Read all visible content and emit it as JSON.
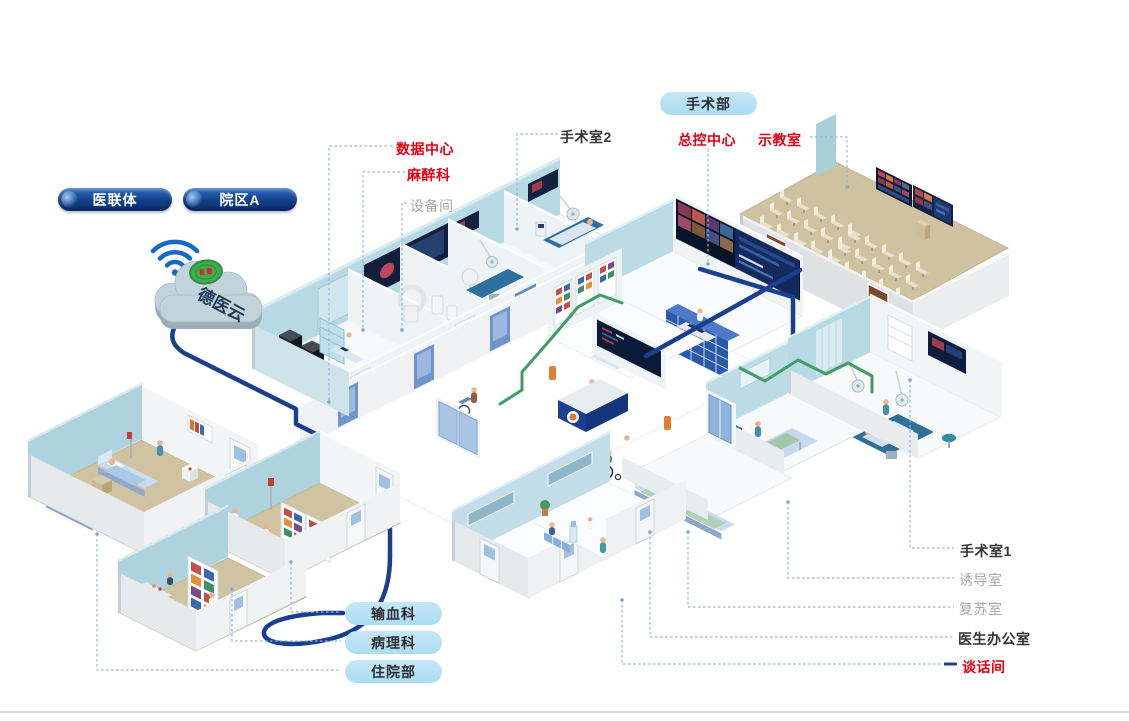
{
  "canvas": {
    "width": 1129,
    "height": 721
  },
  "palette": {
    "label_red": "#e60012",
    "label_dark": "#333333",
    "label_gray": "#a8a8a8",
    "leader_blue": "#8fb7dd",
    "cable_blue": "#1b3f8f",
    "cable_green": "#3f9e63",
    "pill_dark": "#123f86",
    "pill_light": "#aaddf2",
    "wall_teal": "#b7d9e4",
    "floor_tan": "#cfc3a2"
  },
  "icons": {
    "wifi": "wifi-icon",
    "cloud": "cloud-platform-icon"
  },
  "cloud_panel": {
    "pills": [
      {
        "id": "alliance",
        "label": "医联体"
      },
      {
        "id": "campus_a",
        "label": "院区A"
      }
    ],
    "cloud_label": "德医云"
  },
  "surgery_dept_pill": "手术部",
  "callouts": [
    {
      "id": "data-center",
      "label": "数据中心",
      "style": "red"
    },
    {
      "id": "anesthesia",
      "label": "麻醉科",
      "style": "red"
    },
    {
      "id": "equipment-room",
      "label": "设备间",
      "style": "gray"
    },
    {
      "id": "or2",
      "label": "手术室2",
      "style": "dark"
    },
    {
      "id": "master-control",
      "label": "总控中心",
      "style": "red"
    },
    {
      "id": "demo-room",
      "label": "示教室",
      "style": "red"
    },
    {
      "id": "or1",
      "label": "手术室1",
      "style": "dark"
    },
    {
      "id": "induction-room",
      "label": "诱导室",
      "style": "gray"
    },
    {
      "id": "recovery-room",
      "label": "复苏室",
      "style": "gray"
    },
    {
      "id": "doctor-office",
      "label": "医生办公室",
      "style": "dark"
    },
    {
      "id": "talk-room",
      "label": "谈话间",
      "style": "red"
    }
  ],
  "dept_pills": [
    {
      "id": "blood",
      "label": "输血科"
    },
    {
      "id": "pathology",
      "label": "病理科"
    },
    {
      "id": "inpatient",
      "label": "住院部"
    }
  ],
  "wall_texts": {
    "or2": "OR2",
    "or3": "OR3"
  }
}
